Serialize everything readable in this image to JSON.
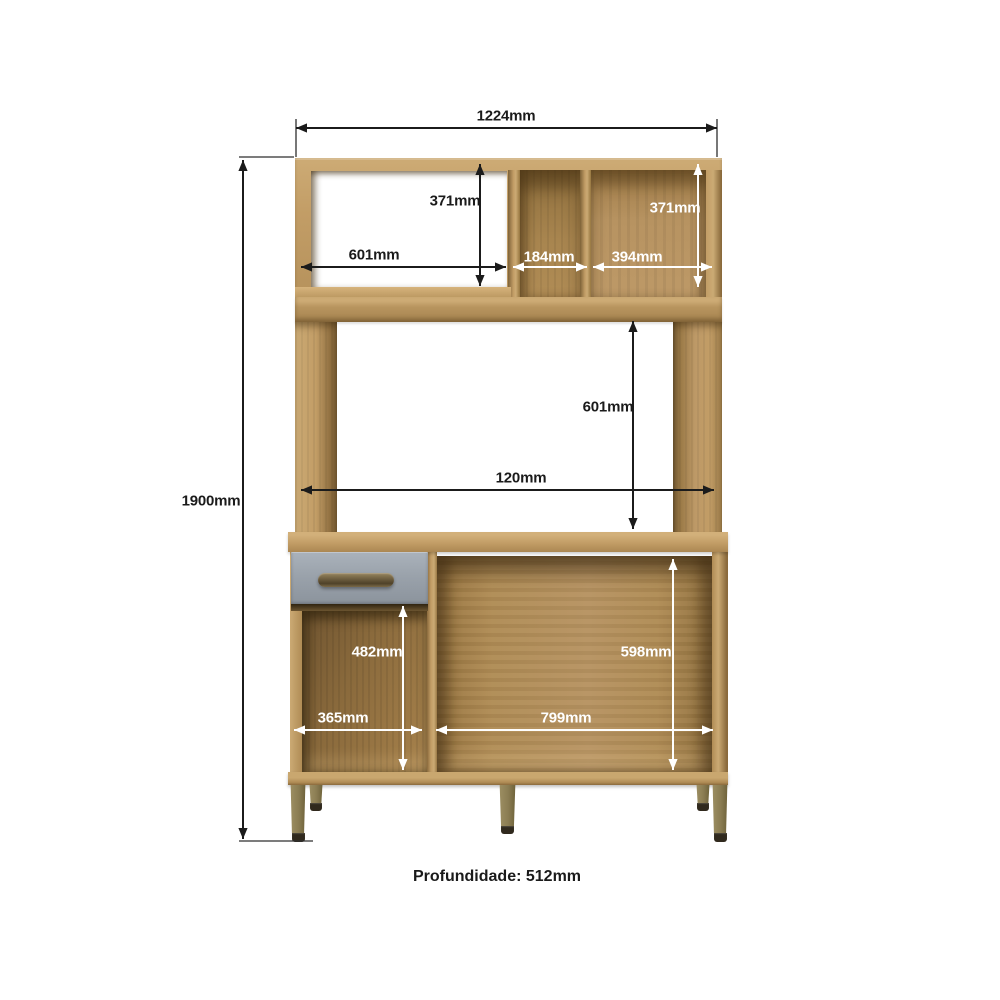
{
  "page": {
    "background": "#ffffff"
  },
  "footer": {
    "depth_label": "Profundidade: 512mm"
  },
  "diagram": {
    "type": "furniture_dimension_diagram",
    "subject": "kitchen-cabinet-hutch",
    "unit": "mm",
    "overall": {
      "width_mm": 1224,
      "height_mm": 1900,
      "depth_mm": 512
    },
    "dimensions": [
      {
        "name": "overall-width",
        "label": "1224mm",
        "value": 1224,
        "axis": "h",
        "color": "dark",
        "x1": 296,
        "y1": 128,
        "x2": 717,
        "y2": 128,
        "lx": 506,
        "ly": 116
      },
      {
        "name": "upper-left-compartment-height",
        "label": "371mm",
        "value": 371,
        "axis": "v",
        "color": "dark",
        "x1": 480,
        "y1": 164,
        "x2": 480,
        "y2": 286,
        "lx": 455,
        "ly": 201
      },
      {
        "name": "upper-left-compartment-width",
        "label": "601mm",
        "value": 601,
        "axis": "h",
        "color": "dark",
        "x1": 301,
        "y1": 267,
        "x2": 506,
        "y2": 267,
        "lx": 374,
        "ly": 255
      },
      {
        "name": "upper-middle-compartment-width",
        "label": "184mm",
        "value": 184,
        "axis": "h",
        "color": "light",
        "x1": 513,
        "y1": 267,
        "x2": 587,
        "y2": 267,
        "lx": 549,
        "ly": 257
      },
      {
        "name": "upper-right-compartment-width",
        "label": "394mm",
        "value": 394,
        "axis": "h",
        "color": "light",
        "x1": 593,
        "y1": 267,
        "x2": 712,
        "y2": 267,
        "lx": 637,
        "ly": 257
      },
      {
        "name": "upper-right-compartment-height",
        "label": "371mm",
        "value": 371,
        "axis": "v",
        "color": "light",
        "x1": 698,
        "y1": 164,
        "x2": 698,
        "y2": 287,
        "lx": 675,
        "ly": 208
      },
      {
        "name": "middle-opening-height",
        "label": "601mm",
        "value": 601,
        "axis": "v",
        "color": "dark",
        "x1": 633,
        "y1": 321,
        "x2": 633,
        "y2": 529,
        "lx": 608,
        "ly": 407
      },
      {
        "name": "middle-opening-width",
        "label": "120mm",
        "value": 120,
        "axis": "h",
        "color": "dark",
        "x1": 301,
        "y1": 490,
        "x2": 714,
        "y2": 490,
        "lx": 521,
        "ly": 478
      },
      {
        "name": "overall-height",
        "label": "1900mm",
        "value": 1900,
        "axis": "v",
        "color": "dark",
        "x1": 243,
        "y1": 160,
        "x2": 243,
        "y2": 839,
        "lx": 211,
        "ly": 501
      },
      {
        "name": "lower-left-compartment-height",
        "label": "482mm",
        "value": 482,
        "axis": "v",
        "color": "light",
        "x1": 403,
        "y1": 606,
        "x2": 403,
        "y2": 770,
        "lx": 377,
        "ly": 652
      },
      {
        "name": "lower-right-compartment-height",
        "label": "598mm",
        "value": 598,
        "axis": "v",
        "color": "light",
        "x1": 673,
        "y1": 559,
        "x2": 673,
        "y2": 770,
        "lx": 646,
        "ly": 652
      },
      {
        "name": "lower-left-compartment-width",
        "label": "365mm",
        "value": 365,
        "axis": "h",
        "color": "light",
        "x1": 294,
        "y1": 730,
        "x2": 422,
        "y2": 730,
        "lx": 343,
        "ly": 718
      },
      {
        "name": "lower-right-compartment-width",
        "label": "799mm",
        "value": 799,
        "axis": "h",
        "color": "light",
        "x1": 436,
        "y1": 730,
        "x2": 713,
        "y2": 730,
        "lx": 566,
        "ly": 718
      }
    ],
    "extension_lines": [
      [
        296,
        119,
        296,
        157
      ],
      [
        717,
        119,
        717,
        157
      ],
      [
        239,
        157,
        294,
        157
      ],
      [
        239,
        841,
        313,
        841
      ]
    ],
    "colors": {
      "background": "#ffffff",
      "dimension_dark": "#1b1b1b",
      "dimension_light": "#ffffff",
      "extension_line": "#2e2e2e",
      "wood_light": "#cbaa74",
      "wood_mid": "#b6925c",
      "wood_dark": "#9a7a48",
      "wood_shadow": "#6f5631",
      "interior_wood": "#a8854f",
      "interior_wood_dark": "#7d6238",
      "drawer_gray": "#9aa2ab",
      "handle_bronze": "#6b5c3e",
      "leg_olive": "#8a7c52",
      "leg_foot": "#30291d"
    }
  }
}
